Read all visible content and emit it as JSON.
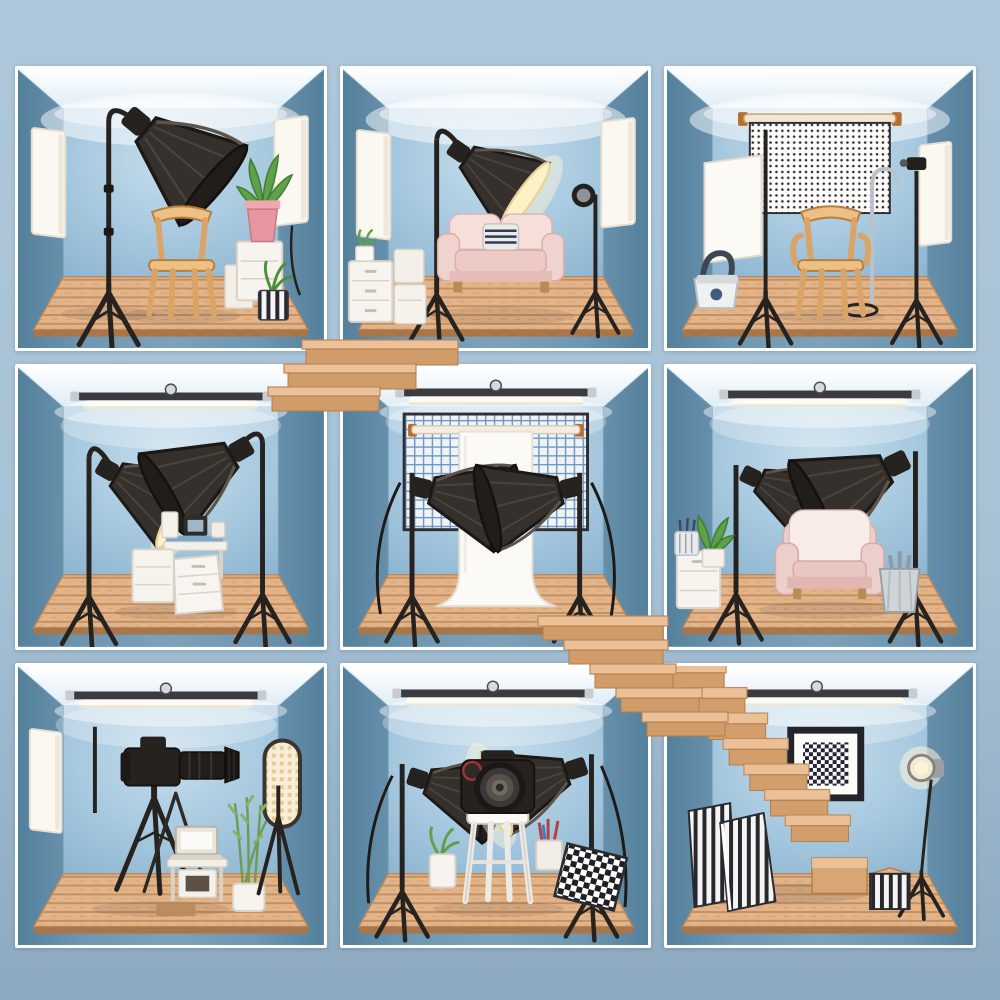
{
  "scene": {
    "title": "Dollhouse cutaway illustration of nine blue photography studio rooms connected by wooden stairs",
    "grid": {
      "rows": 3,
      "cols": 3
    }
  },
  "palette": {
    "background_top": "#aec7da",
    "background_bottom": "#8da9c0",
    "frame_white": "#ffffff",
    "side_wall_blue": "#54809c",
    "back_wall_blue": "#9ec2da",
    "ceiling_white": "#f2f8fc",
    "floor_wood_light": "#e2b083",
    "floor_wood_dark": "#c08b58",
    "equipment_black": "#26221f",
    "softbox_lit_warm": "#fdf2c6",
    "sofa_pink": "#f0d2cf",
    "chair_wood": "#eec084",
    "plant_green": "#5fa148",
    "pot_pink": "#e8969f",
    "prop_white": "#f7f4ef",
    "metal_silver": "#c8ccd0"
  },
  "rooms": [
    {
      "id": "room-top-left",
      "name": "Studio with large dark softbox and wooden chair",
      "items": [
        "softbox-light",
        "light-stand",
        "wooden-chair",
        "plant-in-pink-pot",
        "plant-in-striped-pot",
        "white-pedestal-boxes",
        "wall-reflector-panel-left",
        "wall-reflector-panel-right"
      ]
    },
    {
      "id": "room-top-center",
      "name": "Studio with lit softbox and pink loveseat",
      "items": [
        "lit-softbox-light",
        "light-stand",
        "pink-loveseat",
        "striped-pillow",
        "spotlight-on-stand",
        "white-drawer-unit",
        "canister-stack",
        "small-plant",
        "wall-reflector-panel-left",
        "wall-reflector-panel-right"
      ]
    },
    {
      "id": "room-top-right",
      "name": "Studio with dotted backdrop and wooden armchair",
      "items": [
        "dotted-backdrop",
        "backdrop-rod",
        "wooden-armchair",
        "diffuser-panel-on-stand",
        "flash-on-light-stand",
        "hooked-boom-stand",
        "camera-bag",
        "wall-reflector-panel-right"
      ]
    },
    {
      "id": "room-middle-left",
      "name": "Studio with two facing softboxes and equipment cart",
      "items": [
        "ceiling-tube-light",
        "lit-softbox-light",
        "dark-softbox-light",
        "white-equipment-cart",
        "camera-gear"
      ]
    },
    {
      "id": "room-center",
      "name": "Studio with white seamless backdrop between two octaboxes",
      "items": [
        "ceiling-tube-light",
        "grid-mesh-panel",
        "white-seamless-backdrop",
        "backdrop-rod",
        "octabox-light-left",
        "octabox-light-right",
        "power-cables"
      ]
    },
    {
      "id": "room-middle-right",
      "name": "Studio with pink armchair and two umbrella softboxes",
      "items": [
        "ceiling-tube-light",
        "lit-umbrella-softbox-left",
        "dark-umbrella-softbox-right",
        "pink-armchair",
        "white-cabinet",
        "potted-plant",
        "brush-bin",
        "metal-bucket"
      ]
    },
    {
      "id": "room-bottom-left",
      "name": "Studio with DSLR on tripod, laptop table and oval LED panel",
      "items": [
        "ceiling-tube-light",
        "dslr-camera-with-telephoto-lens",
        "camera-tripod",
        "laptop-on-table",
        "tall-potted-plant",
        "oval-led-panel",
        "spare-stand",
        "wall-reflector-panel-left",
        "floor-mat"
      ]
    },
    {
      "id": "room-bottom-center",
      "name": "Studio with DSLR on white stool between two softboxes",
      "items": [
        "ceiling-tube-light",
        "dslr-camera",
        "white-stool",
        "softbox-light-left",
        "lit-softbox-light-right",
        "potted-plant",
        "pen-cup",
        "checkerboard-reflector"
      ]
    },
    {
      "id": "room-bottom-right",
      "name": "Stairwell room with framed checker artwork and glowing spotlight",
      "items": [
        "ceiling-tube-light",
        "wooden-zigzag-staircase",
        "framed-checker-artwork",
        "glowing-spotlight-on-tripod",
        "striped-boards",
        "striped-cube"
      ]
    }
  ],
  "stairs": [
    {
      "id": "upper-steps",
      "name": "Wooden steps descending left from the top-center studio"
    },
    {
      "id": "lower-staircase",
      "name": "Wooden staircase descending from the center studio into the bottom-right room"
    }
  ]
}
